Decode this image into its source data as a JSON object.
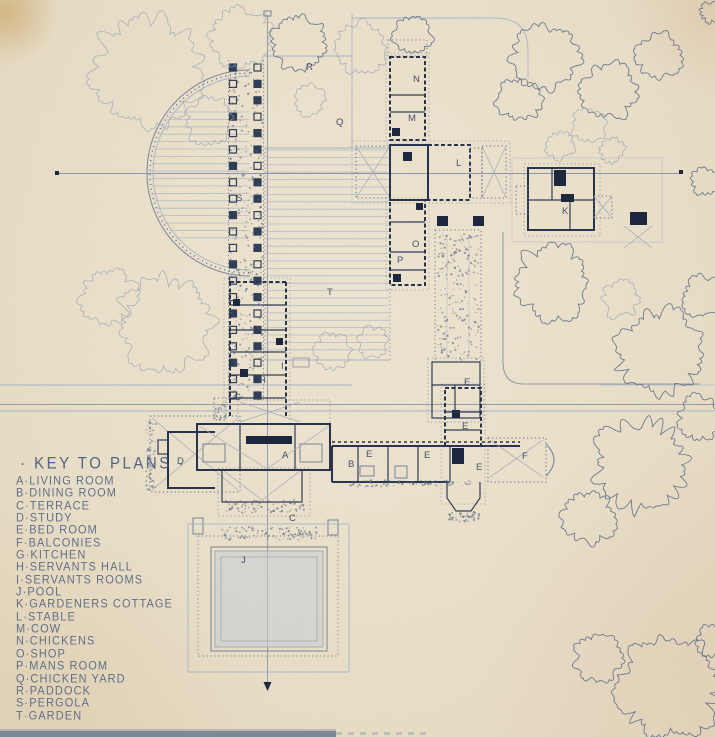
{
  "document": {
    "kind": "hand-drawn architectural site plan, blueprint ink on cream paper"
  },
  "key": {
    "title": "· KEY TO PLANS ·",
    "separator": "·",
    "entries": [
      {
        "letter": "A",
        "name": "LIVING ROOM"
      },
      {
        "letter": "B",
        "name": "DINING ROOM"
      },
      {
        "letter": "C",
        "name": "TERRACE"
      },
      {
        "letter": "D",
        "name": "STUDY"
      },
      {
        "letter": "E",
        "name": "BED ROOM"
      },
      {
        "letter": "F",
        "name": "BALCONIES"
      },
      {
        "letter": "G",
        "name": "KITCHEN"
      },
      {
        "letter": "H",
        "name": "SERVANTS HALL"
      },
      {
        "letter": "I",
        "name": "SERVANTS ROOMS"
      },
      {
        "letter": "J",
        "name": "POOL"
      },
      {
        "letter": "K",
        "name": "GARDENERS COTTAGE"
      },
      {
        "letter": "L",
        "name": "STABLE"
      },
      {
        "letter": "M",
        "name": "COW"
      },
      {
        "letter": "N",
        "name": "CHICKENS"
      },
      {
        "letter": "O",
        "name": "SHOP"
      },
      {
        "letter": "P",
        "name": "MANS ROOM"
      },
      {
        "letter": "Q",
        "name": "CHICKEN YARD"
      },
      {
        "letter": "R",
        "name": "PADDOCK"
      },
      {
        "letter": "S",
        "name": "PERGOLA"
      },
      {
        "letter": "T",
        "name": "GARDEN"
      }
    ]
  },
  "plan": {
    "letters": [
      {
        "label": "A",
        "x": 282,
        "y": 458
      },
      {
        "label": "B",
        "x": 348,
        "y": 467
      },
      {
        "label": "C",
        "x": 289,
        "y": 521
      },
      {
        "label": "D",
        "x": 177,
        "y": 464
      },
      {
        "label": "E",
        "x": 366,
        "y": 457
      },
      {
        "label": "E",
        "x": 424,
        "y": 458
      },
      {
        "label": "E",
        "x": 476,
        "y": 470
      },
      {
        "label": "E",
        "x": 462,
        "y": 429
      },
      {
        "label": "E",
        "x": 464,
        "y": 385
      },
      {
        "label": "F",
        "x": 522,
        "y": 459
      },
      {
        "label": "G",
        "x": 234,
        "y": 400
      },
      {
        "label": "H",
        "x": 259,
        "y": 383
      },
      {
        "label": "I",
        "x": 281,
        "y": 369
      },
      {
        "label": "J",
        "x": 241,
        "y": 563
      },
      {
        "label": "K",
        "x": 562,
        "y": 214
      },
      {
        "label": "L",
        "x": 456,
        "y": 166
      },
      {
        "label": "M",
        "x": 408,
        "y": 121
      },
      {
        "label": "N",
        "x": 413,
        "y": 82
      },
      {
        "label": "O",
        "x": 412,
        "y": 247
      },
      {
        "label": "P",
        "x": 397,
        "y": 263
      },
      {
        "label": "Q",
        "x": 336,
        "y": 125
      },
      {
        "label": "R",
        "x": 306,
        "y": 70
      },
      {
        "label": "S",
        "x": 236,
        "y": 201
      },
      {
        "label": "T",
        "x": 327,
        "y": 295
      }
    ],
    "trees": [
      {
        "x": 148,
        "y": 72,
        "r": 60,
        "light": true
      },
      {
        "x": 242,
        "y": 38,
        "r": 34,
        "light": true
      },
      {
        "x": 300,
        "y": 42,
        "r": 30,
        "light": false
      },
      {
        "x": 360,
        "y": 47,
        "r": 28,
        "light": true
      },
      {
        "x": 412,
        "y": 36,
        "r": 20,
        "light": false
      },
      {
        "x": 210,
        "y": 120,
        "r": 26,
        "light": true
      },
      {
        "x": 310,
        "y": 100,
        "r": 16,
        "light": true
      },
      {
        "x": 520,
        "y": 100,
        "r": 24,
        "light": false
      },
      {
        "x": 545,
        "y": 58,
        "r": 36,
        "light": false
      },
      {
        "x": 608,
        "y": 92,
        "r": 30,
        "light": false
      },
      {
        "x": 658,
        "y": 55,
        "r": 24,
        "light": false
      },
      {
        "x": 588,
        "y": 125,
        "r": 18,
        "light": true
      },
      {
        "x": 560,
        "y": 147,
        "r": 14,
        "light": true
      },
      {
        "x": 612,
        "y": 150,
        "r": 12,
        "light": true
      },
      {
        "x": 705,
        "y": 182,
        "r": 14,
        "light": false
      },
      {
        "x": 552,
        "y": 282,
        "r": 40,
        "light": false
      },
      {
        "x": 620,
        "y": 300,
        "r": 20,
        "light": true
      },
      {
        "x": 658,
        "y": 352,
        "r": 46,
        "light": false
      },
      {
        "x": 703,
        "y": 296,
        "r": 22,
        "light": false
      },
      {
        "x": 640,
        "y": 465,
        "r": 50,
        "light": false
      },
      {
        "x": 588,
        "y": 517,
        "r": 28,
        "light": false
      },
      {
        "x": 700,
        "y": 418,
        "r": 24,
        "light": false
      },
      {
        "x": 165,
        "y": 325,
        "r": 52,
        "light": true
      },
      {
        "x": 108,
        "y": 296,
        "r": 30,
        "light": true
      },
      {
        "x": 333,
        "y": 352,
        "r": 20,
        "light": true
      },
      {
        "x": 371,
        "y": 342,
        "r": 16,
        "light": true
      },
      {
        "x": 668,
        "y": 688,
        "r": 55,
        "light": false
      },
      {
        "x": 598,
        "y": 658,
        "r": 26,
        "light": false
      },
      {
        "x": 712,
        "y": 640,
        "r": 16,
        "light": false
      },
      {
        "x": 710,
        "y": 12,
        "r": 10,
        "light": false
      }
    ]
  },
  "colors": {
    "paper": "#ebe1cb",
    "ink_dark": "#17233c",
    "ink_wall": "#23304a",
    "ink_medium": "#5f7090",
    "ink_light": "#a7b4c8",
    "pool_fill": "#c7cdd8",
    "bottom_band": "#7e8795",
    "corner_stain": "#bc8a3a"
  }
}
